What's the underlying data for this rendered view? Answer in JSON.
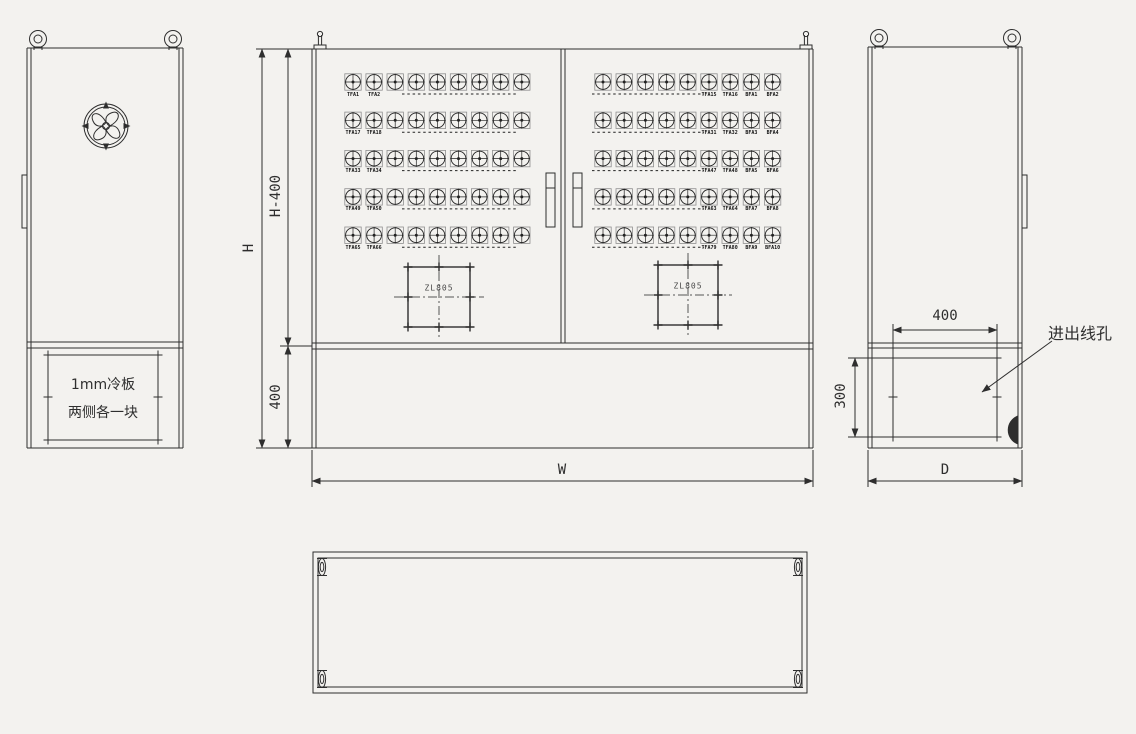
{
  "drawing_title": "cabinet-fabrication-drawing",
  "colors": {
    "background": "#f3f2ef",
    "line": "#2e2e2e"
  },
  "left_view": {
    "cold_plate_note_line1": "1mm冷板",
    "cold_plate_note_line2": "两侧各一块"
  },
  "front_view": {
    "dim_height": "H",
    "dim_height_minus_400": "H-400",
    "dim_plinth_height": "400",
    "dim_width": "W",
    "gland_label": "ZL805",
    "left_door_rows": [
      {
        "labels": [
          "TFA1",
          "TFA2"
        ]
      },
      {
        "labels": [
          "TFA17",
          "TFA18"
        ]
      },
      {
        "labels": [
          "TFA33",
          "TFA34"
        ]
      },
      {
        "labels": [
          "TFA49",
          "TFA50"
        ]
      },
      {
        "labels": [
          "TFA65",
          "TFA66"
        ]
      }
    ],
    "right_door_rows": [
      {
        "labels": [
          "TFA15",
          "TFA16",
          "BFA1",
          "BFA2"
        ]
      },
      {
        "labels": [
          "TFA31",
          "TFA32",
          "BFA3",
          "BFA4"
        ]
      },
      {
        "labels": [
          "TFA47",
          "TFA48",
          "BFA5",
          "BFA6"
        ]
      },
      {
        "labels": [
          "TFA63",
          "TFA64",
          "BFA7",
          "BFA8"
        ]
      },
      {
        "labels": [
          "TFA79",
          "TFA80",
          "BFA9",
          "BFA10"
        ]
      }
    ]
  },
  "side_view": {
    "dim_hole_width": "400",
    "dim_hole_height": "300",
    "dim_depth": "D",
    "callout_cable_hole": "进出线孔"
  }
}
